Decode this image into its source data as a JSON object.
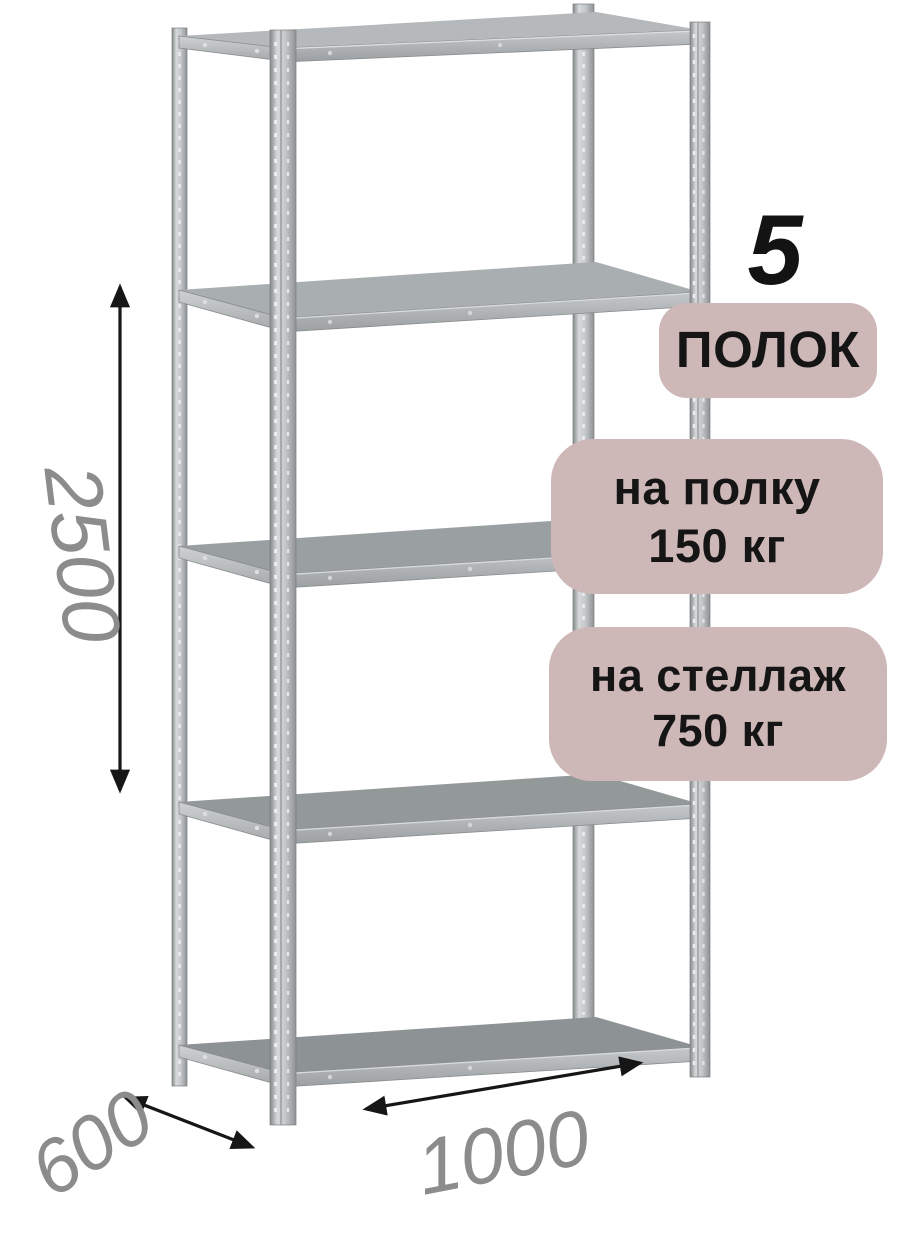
{
  "product": {
    "type_label": "metal-shelving-rack"
  },
  "badges": {
    "shelf_count": {
      "number": "5",
      "label": "ПОЛОК"
    },
    "per_shelf": {
      "line1": "на полку",
      "line2": "150 кг"
    },
    "per_rack": {
      "line1": "на стеллаж",
      "line2": "750 кг"
    }
  },
  "dimensions": {
    "height_mm": "2500",
    "depth_mm": "600",
    "width_mm": "1000"
  },
  "colors": {
    "badge_bg": "#cdb7b7",
    "badge_text": "#151515",
    "dimension_text": "#8c8c8c",
    "arrow": "#161616",
    "rack_metal_light": "#d6d9da",
    "rack_metal_dark": "#8e9294",
    "shelf_top_gray": "#8d9294",
    "background": "#ffffff"
  }
}
